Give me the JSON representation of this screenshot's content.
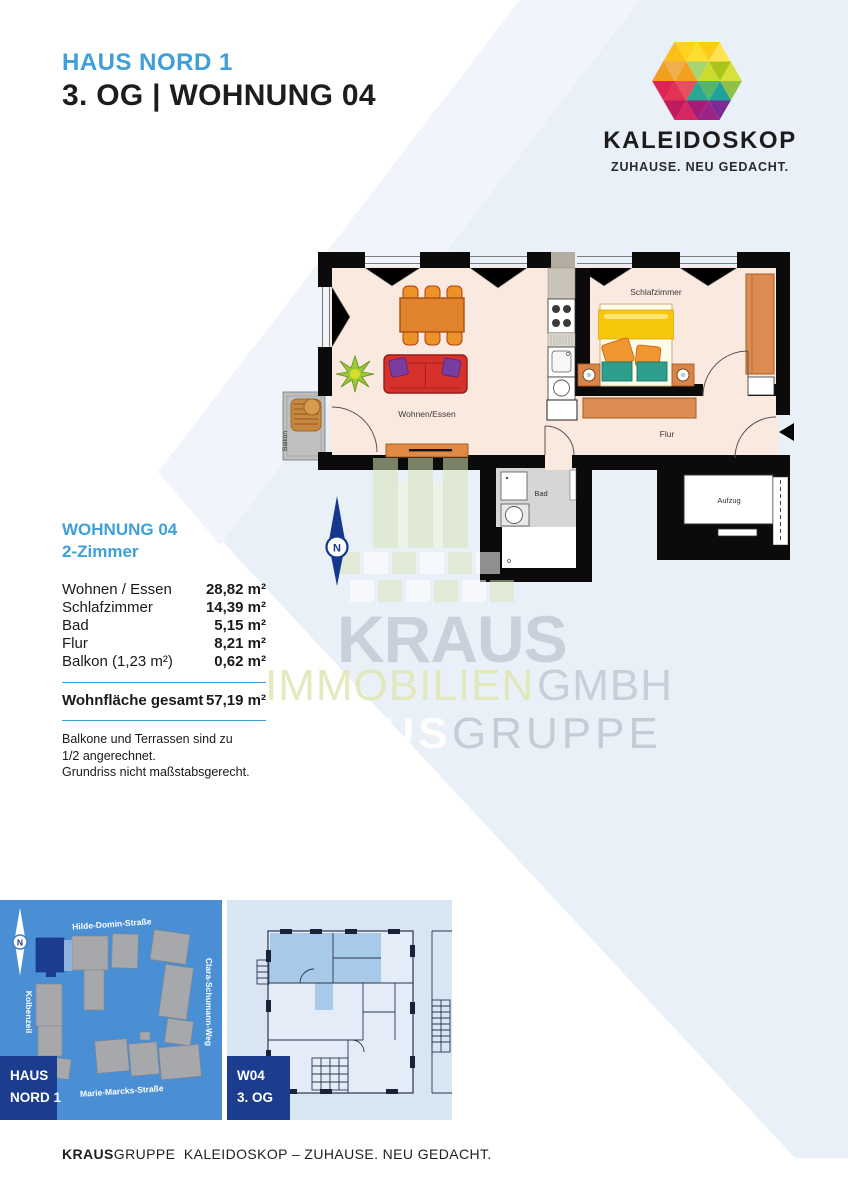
{
  "header": {
    "building": "HAUS NORD 1",
    "unit_line": "3. OG | WOHNUNG 04"
  },
  "logo": {
    "name": "KALEIDOSKOP",
    "tagline": "ZUHAUSE. NEU GEDACHT."
  },
  "plan": {
    "labels": {
      "living": "Wohnen/Essen",
      "bedroom": "Schlafzimmer",
      "hall": "Flur",
      "bath": "Bad",
      "elevator": "Aufzug",
      "balcony": "Balkon"
    },
    "compass_n": "N"
  },
  "areas": {
    "title": "WOHNUNG 04",
    "subtitle": "2-Zimmer",
    "rows": [
      {
        "label": "Wohnen / Essen",
        "value": "28,82 m²"
      },
      {
        "label": "Schlafzimmer",
        "value": "14,39 m²"
      },
      {
        "label": "Bad",
        "value": "5,15 m²"
      },
      {
        "label": "Flur",
        "value": "8,21 m²"
      },
      {
        "label": "Balkon (1,23 m²)",
        "value": "0,62 m²"
      }
    ],
    "total_label": "Wohnfläche gesamt",
    "total_value": "57,19 m²",
    "notes": [
      "Balkone und Terrassen sind zu",
      "1/2 angerechnet.",
      "Grundriss nicht maßstabsgerecht."
    ]
  },
  "watermark": {
    "kraus": "KRAUS",
    "immobilien": "IMMOBILIEN",
    "gmbh": "GMBH",
    "group_bold": "KRAUS",
    "group_light": "GRUPPE"
  },
  "sitemap": {
    "streets": {
      "top": "Hilde-Domin-Straße",
      "right": "Clara-Schumann-Weg",
      "left": "Kolbenzeil",
      "bottom": "Marie-Marcks-Straße"
    },
    "label_line1": "HAUS",
    "label_line2": "NORD 1",
    "compass_n": "N"
  },
  "overview": {
    "label_line1": "W04",
    "label_line2": "3. OG"
  },
  "footer": {
    "bold": "KRAUS",
    "rest": "GRUPPE  KALEIDOSKOP – ZUHAUSE. NEU GEDACHT."
  },
  "colors": {
    "accent_blue": "#3F9FD8",
    "dark_blue": "#1C3D8E",
    "map_blue": "#4A8ED4",
    "panel_blue": "#D8E5F3",
    "highlight_blue": "#A6CAE8",
    "bg_diagonal": "#EAF0F8",
    "floor": "#FAE9DF",
    "wall": "#0b0b0b"
  }
}
